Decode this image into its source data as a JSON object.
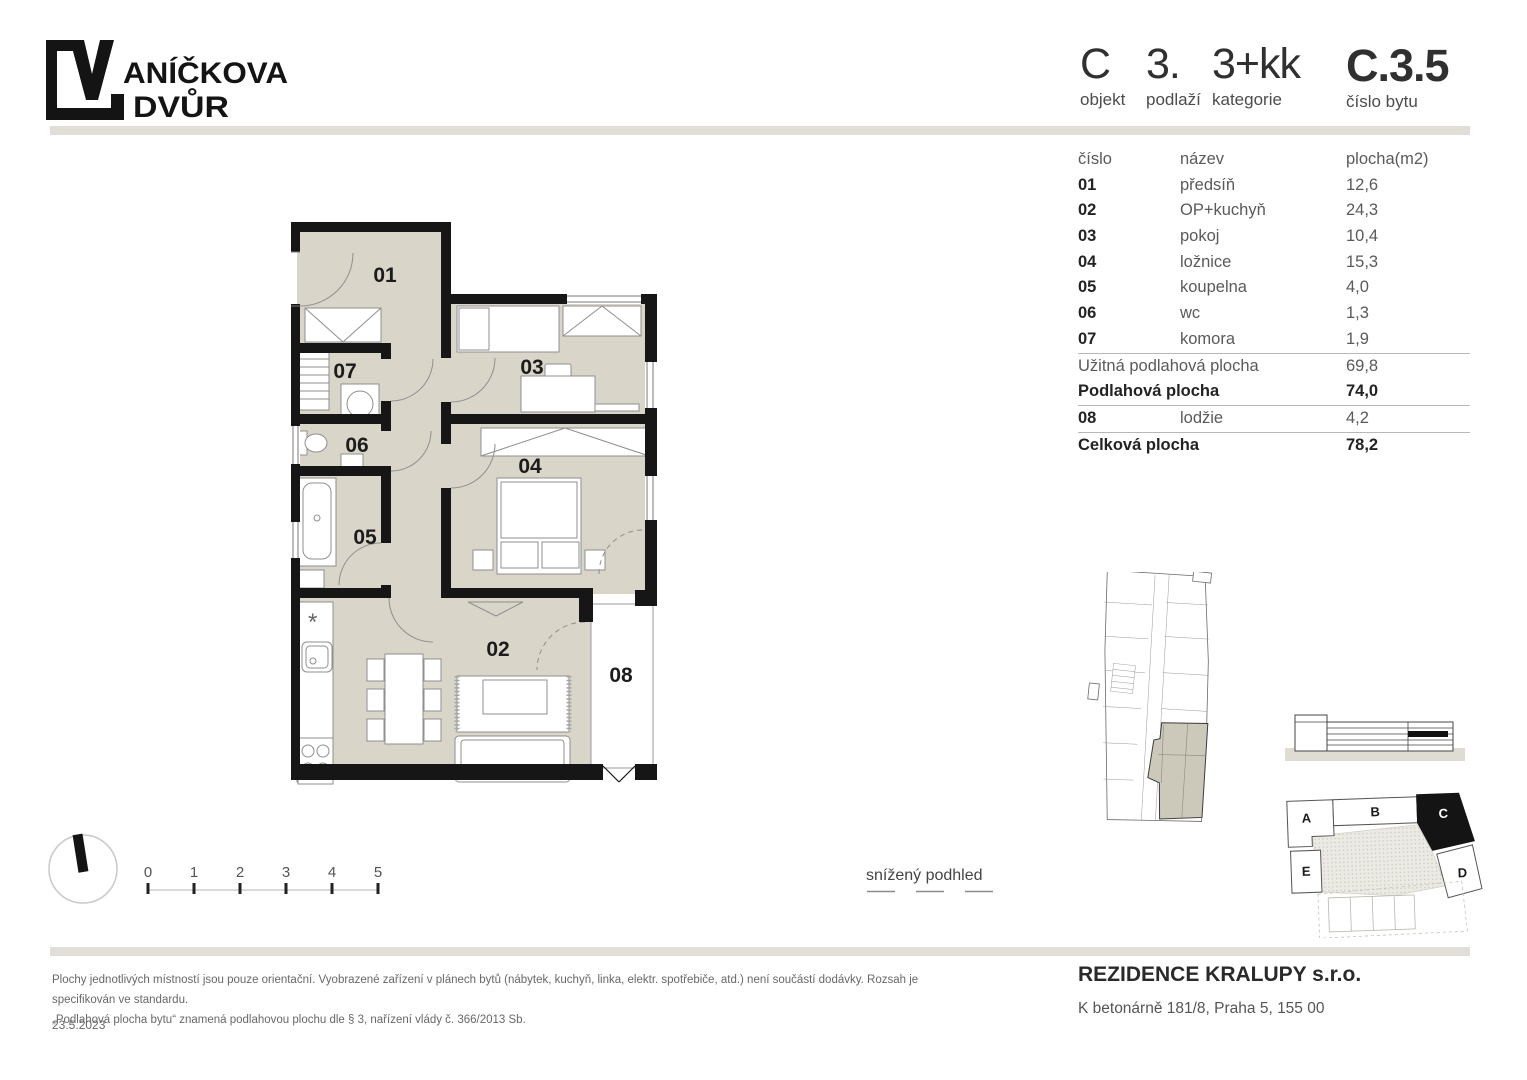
{
  "brand": {
    "name_full": "VANÍČKOVA DVŮR",
    "name_line1_after_glyph": "ANÍČKOVA",
    "name_line2": "DVŮR"
  },
  "header": {
    "fields": [
      {
        "value": "C",
        "label": "objekt"
      },
      {
        "value": "3.",
        "label": "podlaží"
      },
      {
        "value": "3+kk",
        "label": "kategorie"
      },
      {
        "value": "C.3.5",
        "label": "číslo bytu"
      }
    ]
  },
  "room_table": {
    "col_number": "číslo",
    "col_name": "název",
    "col_area": "plocha(m2)",
    "rows": [
      {
        "number": "01",
        "name": "předsíň",
        "area": "12,6"
      },
      {
        "number": "02",
        "name": "OP+kuchyň",
        "area": "24,3"
      },
      {
        "number": "03",
        "name": "pokoj",
        "area": "10,4"
      },
      {
        "number": "04",
        "name": "ložnice",
        "area": "15,3"
      },
      {
        "number": "05",
        "name": "koupelna",
        "area": "4,0"
      },
      {
        "number": "06",
        "name": "wc",
        "area": "1,3"
      },
      {
        "number": "07",
        "name": "komora",
        "area": "1,9"
      }
    ],
    "usable_label": "Užitná podlahová plocha",
    "usable_value": "69,8",
    "floor_label": "Podlahová plocha",
    "floor_value": "74,0",
    "extra": {
      "number": "08",
      "name": "lodžie",
      "area": "4,2"
    },
    "total_label": "Celková plocha",
    "total_value": "78,2"
  },
  "plan": {
    "rooms": [
      {
        "label": "01"
      },
      {
        "label": "02"
      },
      {
        "label": "03"
      },
      {
        "label": "04"
      },
      {
        "label": "05"
      },
      {
        "label": "06"
      },
      {
        "label": "07"
      },
      {
        "label": "08"
      }
    ],
    "kitchen_symbol": "*",
    "legend_snizeny_podhled": "snížený podhled"
  },
  "scale_bar": {
    "ticks": [
      "0",
      "1",
      "2",
      "3",
      "4",
      "5"
    ]
  },
  "site_plan": {
    "buildings": [
      {
        "label": "A"
      },
      {
        "label": "B"
      },
      {
        "label": "C"
      },
      {
        "label": "D"
      },
      {
        "label": "E"
      }
    ]
  },
  "footer": {
    "disclaimer_line1": "Plochy jednotlivých místností jsou pouze orientační. Vyobrazené zařízení v plánech bytů (nábytek, kuchyň, linka, elektr. spotřebiče, atd.) není součástí dodávky. Rozsah je specifikován ve standardu.",
    "disclaimer_line2": "„Podlahová plocha bytu“ znamená podlahovou plochu dle § 3, nařízení vlády č. 366/2013 Sb.",
    "date": "23.5.2023",
    "company": "REZIDENCE KRALUPY s.r.o.",
    "address": "K betonárně 181/8, Praha 5, 155 00"
  },
  "colors": {
    "wall": "#161616",
    "floor_fill": "#d9d5c9",
    "divider": "#e0ded6",
    "apartment_highlight": "#ccc8ba"
  }
}
